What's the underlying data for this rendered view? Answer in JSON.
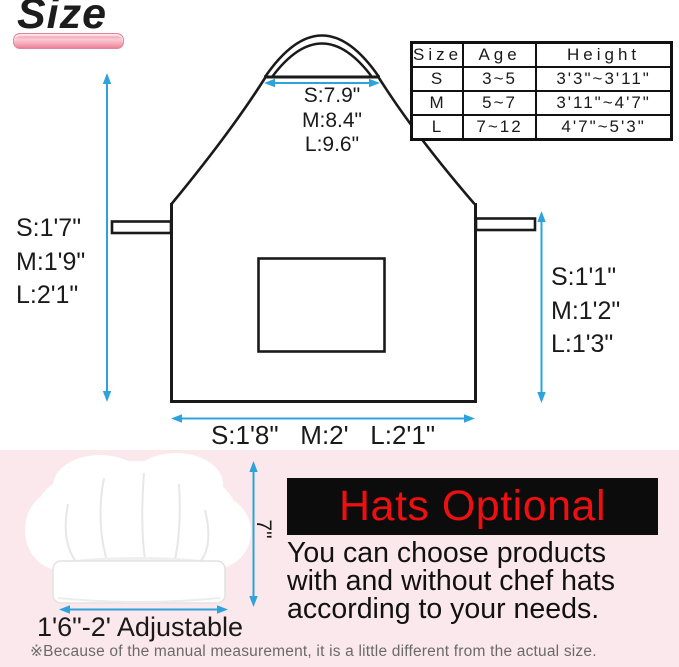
{
  "title": "Size",
  "size_table": {
    "headers": [
      "Size",
      "Age",
      "Height"
    ],
    "rows": [
      {
        "size": "S",
        "age": "3~5",
        "height": "3'3\"~3'11\""
      },
      {
        "size": "M",
        "age": "5~7",
        "height": "3'11\"~4'7\""
      },
      {
        "size": "L",
        "age": "7~12",
        "height": "4'7\"~5'3\""
      }
    ]
  },
  "apron_measurements": {
    "neck_width": {
      "s": "S:7.9\"",
      "m": "M:8.4\"",
      "l": "L:9.6\""
    },
    "left_height": {
      "s": "S:1'7\"",
      "m": "M:1'9\"",
      "l": "L:2'1\""
    },
    "right_drop": {
      "s": "S:1'1\"",
      "m": "M:1'2\"",
      "l": "L:1'3\""
    },
    "bottom_width": "S:1'8\"   M:2'   L:2'1\""
  },
  "hat": {
    "height_label": "7\"",
    "width_label": "1'6\"-2' Adjustable"
  },
  "hats_optional": {
    "heading": "Hats Optional",
    "body_lines": [
      "You can choose products",
      "with and without chef hats",
      "according to your needs."
    ]
  },
  "note": "※Because of the manual measurement, it is a little different from the actual size.",
  "colors": {
    "arrow_blue": "#2ea3db",
    "title_underline_pink": "#f2a0b2",
    "bottom_background_pink": "#fbe8ec",
    "heading_red": "#ee1010",
    "box_black": "#0c0c0c",
    "line_black": "#1a1a1a"
  }
}
